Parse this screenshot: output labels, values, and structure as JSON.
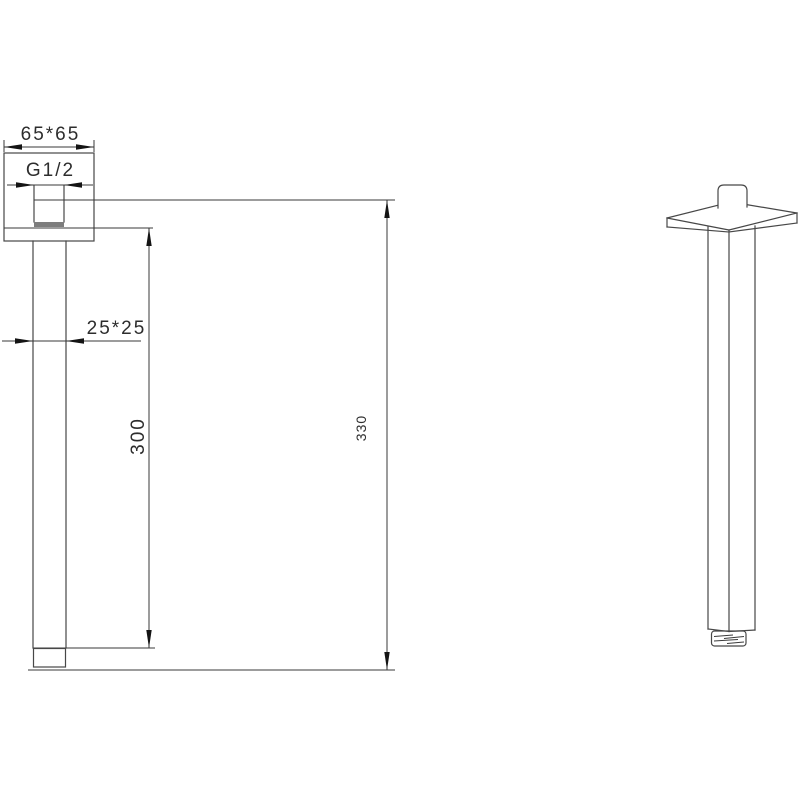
{
  "drawing": {
    "type": "technical-drawing",
    "subject": "ceiling-mount square shower arm",
    "views": {
      "front_view": "dimensioned front elevation",
      "side_view": "perspective projection"
    },
    "dimensions": {
      "flange_size": "65*65",
      "thread_size": "G1/2",
      "arm_section": "25*25",
      "arm_length": "300",
      "overall_length": "330"
    },
    "colors": {
      "background": "#ffffff",
      "object_line": "#474747",
      "dimension_line": "#3a3a3a",
      "arrow_fill": "#141414",
      "thread_bottom_fill": "#7d7d7d",
      "label_text": "#2d2d2d"
    }
  }
}
